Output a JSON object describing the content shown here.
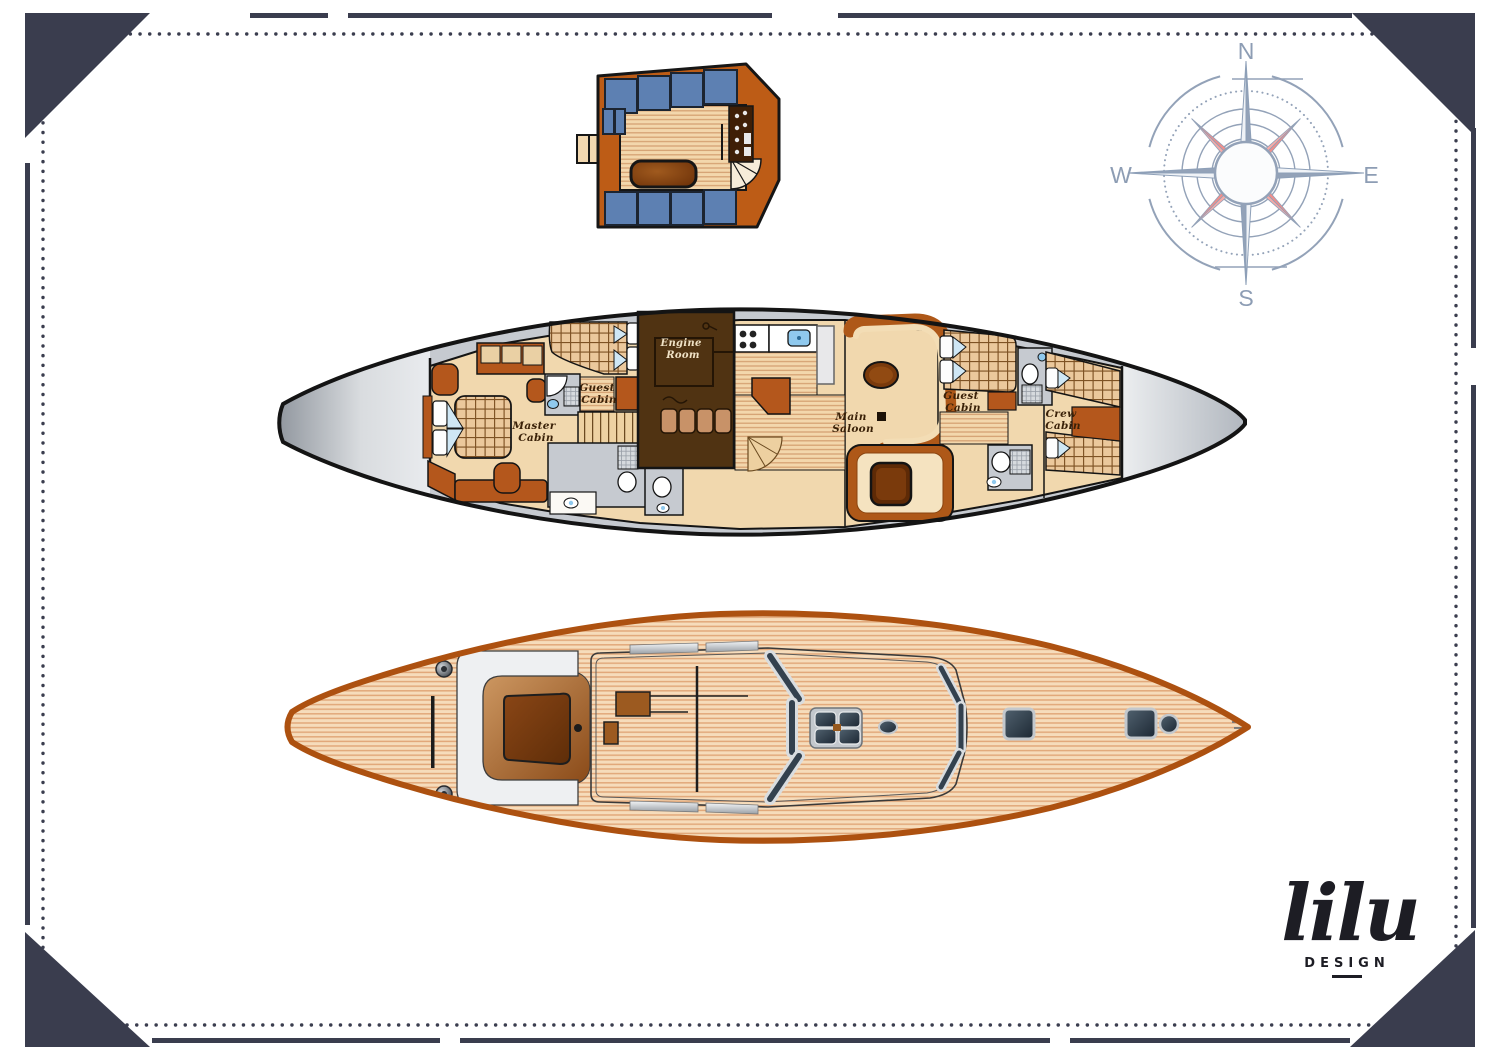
{
  "palette": {
    "frame_navy": "#3a3d4e",
    "hull_outline_black": "#141414",
    "deck_outline_orange": "#ad5110",
    "deck_wood": "#f6dcbb",
    "interior_beige": "#f1d8ae",
    "furniture_brown": "#b4571c",
    "dark_wood": "#6b3008",
    "engine_room_brown": "#503312",
    "cushion_blue": "#5d80b2",
    "deck_gray": "#c6cad0",
    "water_blue": "#8fc9ee",
    "compass_gray_blue": "#93a2b8",
    "compass_pink": "#f4a09d"
  },
  "compass": {
    "north": "N",
    "east": "E",
    "south": "S",
    "west": "W"
  },
  "interior_plan": {
    "labels": {
      "master_cabin": {
        "line1": "Master",
        "line2": "Cabin"
      },
      "guest_cabin_aft": {
        "line1": "Guest",
        "line2": "Cabin"
      },
      "engine_room": {
        "line1": "Engine",
        "line2": "Room"
      },
      "main_saloon": {
        "line1": "Main",
        "line2": "Saloon"
      },
      "guest_cabin_fwd": {
        "line1": "Guest",
        "line2": "Cabin"
      },
      "crew_cabin": {
        "line1": "Crew",
        "line2": "Cabin"
      }
    }
  },
  "logo": {
    "wordmark": "lilu",
    "subtitle": "DESIGN"
  }
}
